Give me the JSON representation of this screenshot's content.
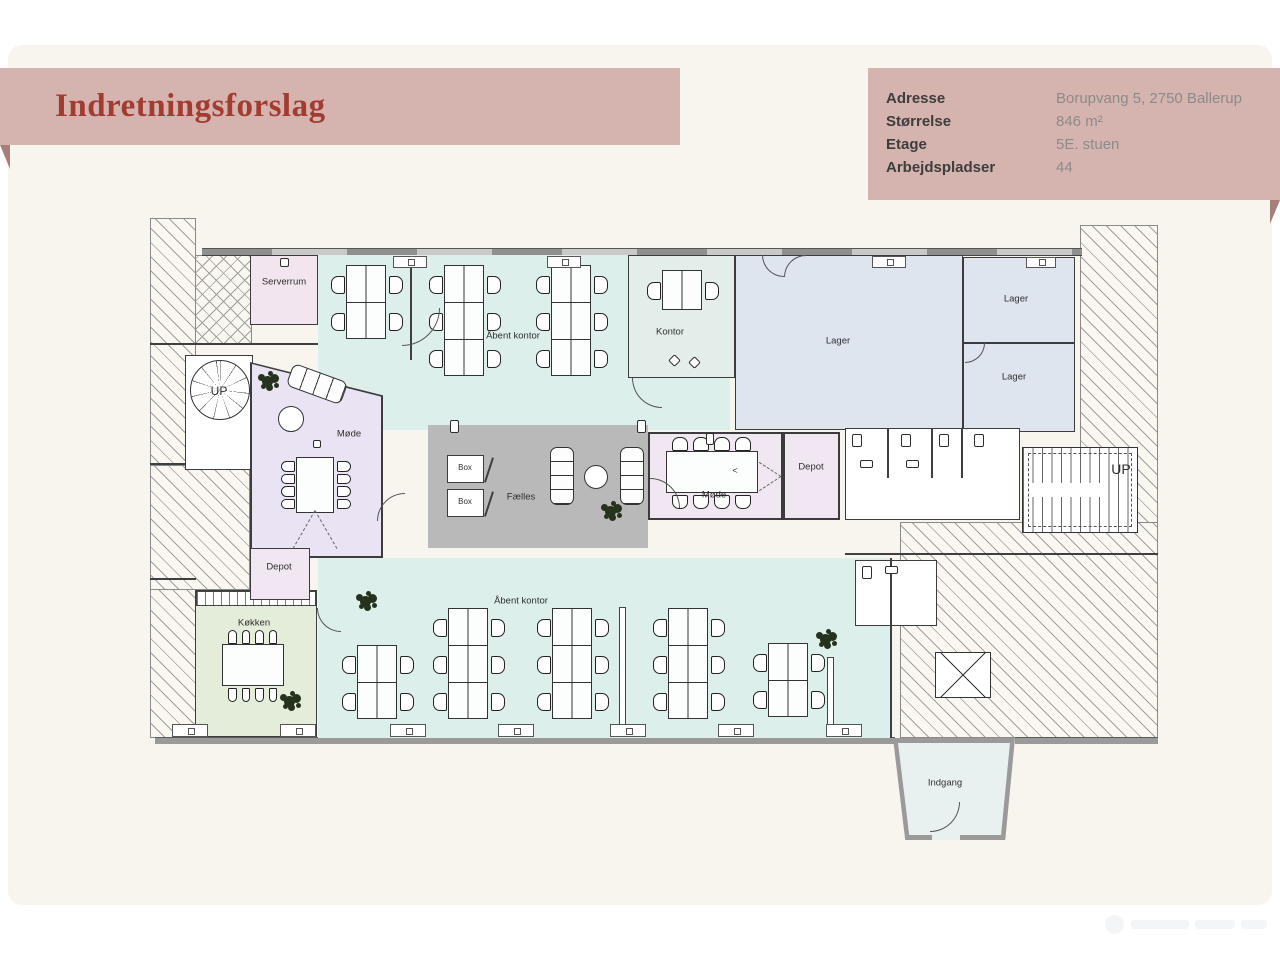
{
  "page": {
    "title": "Indretningsforslag"
  },
  "info": {
    "rows": [
      {
        "label": "Adresse",
        "value": "Borupvang 5, 2750 Ballerup"
      },
      {
        "label": "Størrelse",
        "value": "846 m²"
      },
      {
        "label": "Etage",
        "value": "5E. stuen"
      },
      {
        "label": "Arbejdspladser",
        "value": "44"
      }
    ]
  },
  "colors": {
    "teal": "#ddefeb",
    "blue": "#dfe5ee",
    "pink": "#f2e5ef",
    "lavender": "#eae3f3",
    "pinklight": "#f1e7f2",
    "gray": "#b9b9ba",
    "green": "#e4ecda",
    "kontorfill": "#e3edea",
    "white": "#ffffff",
    "entr": "#e8f1ef",
    "banner": "#d5b4b0",
    "fold": "#a87e7b",
    "title_red": "#a23b30",
    "card": "#f8f4ee",
    "wallgray": "#9a9a9a"
  },
  "plan": {
    "items": [
      {
        "t": "hatch",
        "name": "exterior-left",
        "x": 0,
        "y": 8,
        "w": 46,
        "h": 520
      },
      {
        "t": "hatch",
        "name": "exterior-left-mid",
        "x": 0,
        "y": 255,
        "w": 100,
        "h": 125
      },
      {
        "t": "cross",
        "name": "exterior-topleft",
        "x": 45,
        "y": 45,
        "w": 57,
        "h": 90
      },
      {
        "t": "hatch",
        "name": "exterior-right",
        "x": 930,
        "y": 15,
        "w": 78,
        "h": 513
      },
      {
        "t": "hatch",
        "name": "exterior-bottomright",
        "x": 750,
        "y": 312,
        "w": 258,
        "h": 216
      },
      {
        "t": "wallwin",
        "name": "facade-top",
        "x": 52,
        "y": 38,
        "w": 880,
        "h": 8
      },
      {
        "t": "gwall",
        "name": "facade-bottom-left",
        "x": 5,
        "y": 527,
        "w": 740,
        "h": 7
      },
      {
        "t": "gwall",
        "name": "facade-bottom-right",
        "x": 865,
        "y": 527,
        "w": 143,
        "h": 7
      },
      {
        "t": "wall",
        "name": "wall-topleft-divider",
        "x": 0,
        "y": 133,
        "w": 168,
        "h": 2
      },
      {
        "t": "wall",
        "name": "wall-leftband-cut1",
        "x": 0,
        "y": 253,
        "w": 46,
        "h": 2
      },
      {
        "t": "wall",
        "name": "wall-leftband-cut2",
        "x": 0,
        "y": 368,
        "w": 46,
        "h": 2
      },
      {
        "t": "room",
        "name": "room-open-office-top",
        "x": 168,
        "y": 45,
        "w": 412,
        "h": 175,
        "fill": "teal",
        "b": 0
      },
      {
        "t": "room",
        "name": "room-open-office-bottom",
        "x": 168,
        "y": 348,
        "w": 572,
        "h": 180,
        "fill": "teal",
        "b": 0
      },
      {
        "t": "room",
        "name": "room-serverrum",
        "x": 100,
        "y": 45,
        "w": 68,
        "h": 70,
        "fill": "pink"
      },
      {
        "t": "room",
        "name": "room-kontor",
        "x": 478,
        "y": 45,
        "w": 107,
        "h": 123,
        "fill": "kontorfill"
      },
      {
        "t": "room",
        "name": "room-lager-big",
        "x": 585,
        "y": 45,
        "w": 228,
        "h": 175,
        "fill": "blue"
      },
      {
        "t": "room",
        "name": "room-lager-top",
        "x": 813,
        "y": 47,
        "w": 112,
        "h": 86,
        "fill": "blue"
      },
      {
        "t": "room",
        "name": "room-lager-bottom",
        "x": 813,
        "y": 133,
        "w": 112,
        "h": 89,
        "fill": "blue"
      },
      {
        "t": "room",
        "name": "room-stair-left",
        "x": 35,
        "y": 145,
        "w": 68,
        "h": 115,
        "fill": "white"
      },
      {
        "t": "poly",
        "name": "room-moede-left",
        "x": 100,
        "y": 152,
        "w": 133,
        "h": 196,
        "fill": "lavender",
        "clip": "polygon(0 0,100% 17%,100% 100%,0 100%)",
        "inset": 2
      },
      {
        "t": "room",
        "name": "room-koekken",
        "x": 45,
        "y": 380,
        "w": 122,
        "h": 147,
        "fill": "green"
      },
      {
        "t": "counter",
        "name": "kitchen-counter",
        "x": 46,
        "y": 381,
        "w": 120,
        "h": 15
      },
      {
        "t": "room",
        "name": "room-depot-left",
        "x": 100,
        "y": 338,
        "w": 60,
        "h": 52,
        "fill": "pinklight"
      },
      {
        "t": "room",
        "name": "room-faelles",
        "x": 278,
        "y": 215,
        "w": 220,
        "h": 123,
        "fill": "gray",
        "b": 0
      },
      {
        "t": "room",
        "name": "room-moede-center",
        "x": 498,
        "y": 222,
        "w": 135,
        "h": 88,
        "fill": "pinklight",
        "bw": 2
      },
      {
        "t": "room",
        "name": "room-depot-center",
        "x": 633,
        "y": 222,
        "w": 57,
        "h": 88,
        "fill": "pinklight",
        "bw": 2
      },
      {
        "t": "room",
        "name": "room-toilets",
        "x": 695,
        "y": 218,
        "w": 175,
        "h": 92,
        "fill": "white"
      },
      {
        "t": "room",
        "name": "room-toilet-br",
        "x": 705,
        "y": 350,
        "w": 82,
        "h": 66,
        "fill": "white"
      },
      {
        "t": "stair",
        "name": "stair-right",
        "x": 872,
        "y": 237,
        "w": 116,
        "h": 86
      },
      {
        "t": "poly",
        "name": "entrance-vestibule",
        "x": 743,
        "y": 528,
        "w": 122,
        "h": 102,
        "fill": "entr",
        "clip": "polygon(0 0,100% 0,92% 100%,10% 100%)",
        "inset": 5,
        "wallFill": "wallgray"
      },
      {
        "t": "gap",
        "name": "entrance-door-gap",
        "x": 782,
        "y": 621,
        "w": 28,
        "h": 9,
        "fill": "entr"
      },
      {
        "t": "wall",
        "name": "wall-office-east",
        "x": 740,
        "y": 348,
        "w": 2,
        "h": 180
      },
      {
        "t": "wall",
        "name": "wall-hatch-top",
        "x": 695,
        "y": 343,
        "w": 313,
        "h": 2
      },
      {
        "t": "wall",
        "name": "toilet-divider-1",
        "x": 737,
        "y": 218,
        "w": 2,
        "h": 50
      },
      {
        "t": "wall",
        "name": "toilet-divider-2",
        "x": 781,
        "y": 218,
        "w": 2,
        "h": 50
      },
      {
        "t": "wall",
        "name": "toilet-divider-3",
        "x": 811,
        "y": 218,
        "w": 2,
        "h": 50
      },
      {
        "t": "wall",
        "name": "partition-top-office",
        "x": 260,
        "y": 55,
        "w": 2,
        "h": 95
      },
      {
        "t": "post",
        "name": "partition-bottom-office-1",
        "x": 469,
        "y": 397,
        "w": 7,
        "h": 126
      },
      {
        "t": "post",
        "name": "partition-bottom-office-2",
        "x": 677,
        "y": 447,
        "w": 7,
        "h": 80
      },
      {
        "t": "room",
        "name": "phone-box-1",
        "x": 297,
        "y": 245,
        "w": 37,
        "h": 28,
        "fill": "white",
        "bw": 1.2
      },
      {
        "t": "room",
        "name": "phone-box-2",
        "x": 297,
        "y": 279,
        "w": 37,
        "h": 28,
        "fill": "white",
        "bw": 1.2
      },
      {
        "t": "wall",
        "name": "box-1-slash",
        "x": 338,
        "y": 247,
        "w": 2,
        "h": 26,
        "rot": 18
      },
      {
        "t": "wall",
        "name": "box-2-slash",
        "x": 338,
        "y": 281,
        "w": 2,
        "h": 26,
        "rot": 18
      },
      {
        "t": "vdesk",
        "name": "desk-cluster-4p-a",
        "x": 196,
        "y": 55,
        "rows": 2,
        "seats": 4
      },
      {
        "t": "vdesk",
        "name": "desk-cluster-6p-b",
        "x": 294,
        "y": 55,
        "rows": 3,
        "seats": 6
      },
      {
        "t": "vdesk",
        "name": "desk-cluster-6p-c",
        "x": 401,
        "y": 55,
        "rows": 3,
        "seats": 6
      },
      {
        "t": "vdesk",
        "name": "desk-kontor-2p",
        "x": 512,
        "y": 60,
        "rows": 1,
        "seats": 2
      },
      {
        "t": "vdesk",
        "name": "desk-cluster-4p-d",
        "x": 207,
        "y": 435,
        "rows": 2,
        "seats": 4
      },
      {
        "t": "vdesk",
        "name": "desk-cluster-6p-e",
        "x": 298,
        "y": 398,
        "rows": 3,
        "seats": 6
      },
      {
        "t": "vdesk",
        "name": "desk-cluster-6p-f",
        "x": 402,
        "y": 398,
        "rows": 3,
        "seats": 6
      },
      {
        "t": "vdesk",
        "name": "desk-cluster-6p-g",
        "x": 518,
        "y": 398,
        "rows": 3,
        "seats": 6
      },
      {
        "t": "vdesk",
        "name": "desk-cluster-4p-h",
        "x": 618,
        "y": 433,
        "rows": 2,
        "seats": 4
      },
      {
        "t": "vtable",
        "name": "conference-table-moede-left",
        "x": 146,
        "y": 247,
        "w": 38,
        "h": 56
      },
      {
        "t": "htable",
        "name": "conference-table-moede-center",
        "x": 516,
        "y": 241,
        "w": 92,
        "h": 42
      },
      {
        "t": "htable",
        "name": "dining-table-koekken",
        "x": 72,
        "y": 434,
        "w": 62,
        "h": 42
      },
      {
        "t": "sofa",
        "name": "sofa-moede-left",
        "x": 138,
        "y": 162,
        "w": 58,
        "h": 24,
        "rot": 20,
        "dir": "h"
      },
      {
        "t": "sofa",
        "name": "sofa-faelles-1",
        "x": 400,
        "y": 237,
        "w": 24,
        "h": 58,
        "dir": "v"
      },
      {
        "t": "sofa",
        "name": "sofa-faelles-2",
        "x": 470,
        "y": 237,
        "w": 24,
        "h": 58,
        "dir": "v"
      },
      {
        "t": "round",
        "name": "round-table-moede-left",
        "x": 128,
        "y": 196,
        "w": 26,
        "h": 26
      },
      {
        "t": "round",
        "name": "round-table-faelles",
        "x": 434,
        "y": 255,
        "w": 24,
        "h": 24
      },
      {
        "t": "spiral",
        "name": "spiral-stair-left",
        "x": 40,
        "y": 150,
        "w": 60,
        "h": 60
      },
      {
        "t": "plant",
        "name": "plant-moede-left",
        "x": 112,
        "y": 166
      },
      {
        "t": "plant",
        "name": "plant-faelles",
        "x": 455,
        "y": 296
      },
      {
        "t": "plant",
        "name": "plant-office-bottom-left",
        "x": 210,
        "y": 386
      },
      {
        "t": "plant",
        "name": "plant-office-bottom-right",
        "x": 670,
        "y": 424
      },
      {
        "t": "plant",
        "name": "plant-koekken",
        "x": 134,
        "y": 486
      },
      {
        "t": "sill",
        "name": "window-sill-top-1",
        "x": 243,
        "y": 46,
        "w": 34,
        "h": 12
      },
      {
        "t": "sill",
        "name": "window-sill-top-2",
        "x": 397,
        "y": 46,
        "w": 34,
        "h": 12
      },
      {
        "t": "sill",
        "name": "window-sill-top-3",
        "x": 722,
        "y": 46,
        "w": 34,
        "h": 12
      },
      {
        "t": "sill",
        "name": "window-sill-top-4",
        "x": 876,
        "y": 47,
        "w": 30,
        "h": 11
      },
      {
        "t": "sill",
        "name": "window-sill-bottom-1",
        "x": 22,
        "y": 514,
        "w": 36,
        "h": 13
      },
      {
        "t": "sill",
        "name": "window-sill-bottom-2",
        "x": 130,
        "y": 514,
        "w": 36,
        "h": 13
      },
      {
        "t": "sill",
        "name": "window-sill-bottom-3",
        "x": 240,
        "y": 514,
        "w": 36,
        "h": 13
      },
      {
        "t": "sill",
        "name": "window-sill-bottom-4",
        "x": 348,
        "y": 514,
        "w": 36,
        "h": 13
      },
      {
        "t": "sill",
        "name": "window-sill-bottom-5",
        "x": 460,
        "y": 514,
        "w": 36,
        "h": 13
      },
      {
        "t": "sill",
        "name": "window-sill-bottom-6",
        "x": 568,
        "y": 514,
        "w": 36,
        "h": 13
      },
      {
        "t": "sill",
        "name": "window-sill-bottom-7",
        "x": 676,
        "y": 514,
        "w": 36,
        "h": 13
      },
      {
        "t": "wc",
        "name": "wc-1",
        "x": 702,
        "y": 224,
        "w": 10,
        "h": 13
      },
      {
        "t": "wc",
        "name": "wc-2",
        "x": 751,
        "y": 224,
        "w": 10,
        "h": 13
      },
      {
        "t": "wc",
        "name": "wc-3",
        "x": 789,
        "y": 224,
        "w": 10,
        "h": 13
      },
      {
        "t": "wc",
        "name": "wc-4",
        "x": 824,
        "y": 224,
        "w": 10,
        "h": 13
      },
      {
        "t": "wc",
        "name": "sink-1",
        "x": 710,
        "y": 250,
        "w": 13,
        "h": 8
      },
      {
        "t": "wc",
        "name": "sink-2",
        "x": 756,
        "y": 250,
        "w": 13,
        "h": 8
      },
      {
        "t": "wc",
        "name": "wc-br",
        "x": 712,
        "y": 356,
        "w": 10,
        "h": 13
      },
      {
        "t": "wc",
        "name": "sink-br",
        "x": 735,
        "y": 356,
        "w": 13,
        "h": 8
      },
      {
        "t": "xbox",
        "name": "shaft-box",
        "x": 785,
        "y": 442,
        "w": 56,
        "h": 46
      },
      {
        "t": "wc",
        "name": "faelles-door-post-1",
        "x": 300,
        "y": 210,
        "w": 9,
        "h": 13
      },
      {
        "t": "wc",
        "name": "faelles-door-post-2",
        "x": 487,
        "y": 210,
        "w": 9,
        "h": 13
      },
      {
        "t": "wc",
        "name": "serverrum-fixture",
        "x": 130,
        "y": 48,
        "w": 9,
        "h": 9
      },
      {
        "t": "wc",
        "name": "moede-center-fixture",
        "x": 556,
        "y": 223,
        "w": 8,
        "h": 12
      },
      {
        "t": "wc",
        "name": "moede-left-fixture",
        "x": 163,
        "y": 230,
        "w": 8,
        "h": 8
      },
      {
        "t": "wc",
        "name": "kontor-side-chair-1",
        "x": 520,
        "y": 146,
        "w": 9,
        "h": 9,
        "rot": 45
      },
      {
        "t": "wc",
        "name": "kontor-side-chair-2",
        "x": 540,
        "y": 148,
        "w": 9,
        "h": 9,
        "rot": 45
      },
      {
        "t": "arc",
        "name": "door-serverrum",
        "x": 252,
        "y": 98,
        "w": 38,
        "h": 38,
        "rot": 0
      },
      {
        "t": "arc",
        "name": "door-kontor",
        "x": 482,
        "y": 168,
        "w": 30,
        "h": 30,
        "rot": 90
      },
      {
        "t": "arc",
        "name": "door-moede-center",
        "x": 500,
        "y": 268,
        "w": 30,
        "h": 30,
        "rot": 270
      },
      {
        "t": "arc",
        "name": "door-moede-left",
        "x": 227,
        "y": 283,
        "w": 28,
        "h": 28,
        "rot": 180
      },
      {
        "t": "arc",
        "name": "door-entrance",
        "x": 780,
        "y": 592,
        "w": 30,
        "h": 30,
        "rot": 0
      },
      {
        "t": "arc",
        "name": "door-lager-double-1",
        "x": 612,
        "y": 45,
        "w": 22,
        "h": 22,
        "rot": 90
      },
      {
        "t": "arc",
        "name": "door-lager-double-2",
        "x": 634,
        "y": 45,
        "w": 22,
        "h": 22,
        "rot": 180
      },
      {
        "t": "arc",
        "name": "door-lager-mid",
        "x": 815,
        "y": 133,
        "w": 20,
        "h": 20,
        "rot": 0
      },
      {
        "t": "arc",
        "name": "door-koekken",
        "x": 167,
        "y": 398,
        "w": 24,
        "h": 24,
        "rot": 90
      },
      {
        "t": "dash",
        "name": "projection-line-left-1",
        "x": 165,
        "y": 300,
        "w": 44,
        "rot": 60
      },
      {
        "t": "dash",
        "name": "projection-line-left-2",
        "x": 165,
        "y": 300,
        "w": 44,
        "rot": 120
      },
      {
        "t": "dash",
        "name": "projection-line-center-1",
        "x": 631,
        "y": 266,
        "w": 26,
        "rot": 147
      },
      {
        "t": "dash",
        "name": "projection-line-center-2",
        "x": 631,
        "y": 266,
        "w": 26,
        "rot": 213
      },
      {
        "t": "label",
        "name": "label-serverrum",
        "x": 134,
        "y": 72,
        "label": "Serverrum"
      },
      {
        "t": "label",
        "name": "label-open-office-top",
        "x": 363,
        "y": 126,
        "label": "Åbent kontor"
      },
      {
        "t": "label",
        "name": "label-kontor",
        "x": 520,
        "y": 122,
        "label": "Kontor"
      },
      {
        "t": "label",
        "name": "label-lager-big",
        "x": 688,
        "y": 131,
        "label": "Lager"
      },
      {
        "t": "label",
        "name": "label-lager-top",
        "x": 866,
        "y": 89,
        "label": "Lager"
      },
      {
        "t": "label",
        "name": "label-lager-bottom",
        "x": 864,
        "y": 167,
        "label": "Lager"
      },
      {
        "t": "label",
        "name": "label-moede-left",
        "x": 199,
        "y": 224,
        "label": "Møde"
      },
      {
        "t": "label",
        "name": "label-depot-left",
        "x": 129,
        "y": 357,
        "label": "Depot"
      },
      {
        "t": "label",
        "name": "label-koekken",
        "x": 104,
        "y": 413,
        "label": "Køkken"
      },
      {
        "t": "label",
        "name": "label-faelles",
        "x": 371,
        "y": 287,
        "label": "Fælles"
      },
      {
        "t": "label",
        "name": "label-box-1",
        "x": 315,
        "y": 258,
        "label": "Box",
        "fs": 8
      },
      {
        "t": "label",
        "name": "label-box-2",
        "x": 315,
        "y": 292,
        "label": "Box",
        "fs": 8
      },
      {
        "t": "label",
        "name": "label-moede-center",
        "x": 564,
        "y": 285,
        "label": "Møde"
      },
      {
        "t": "label",
        "name": "label-depot-center",
        "x": 661,
        "y": 257,
        "label": "Depot"
      },
      {
        "t": "label",
        "name": "label-open-office-bottom",
        "x": 371,
        "y": 391,
        "label": "Åbent kontor"
      },
      {
        "t": "label",
        "name": "label-indgang",
        "x": 795,
        "y": 573,
        "label": "Indgang"
      },
      {
        "t": "label",
        "name": "label-up-left",
        "x": 69,
        "y": 181,
        "label": "UP",
        "fs": 12
      },
      {
        "t": "label",
        "name": "label-up-right",
        "x": 971,
        "y": 259,
        "label": "UP",
        "fs": 14
      },
      {
        "t": "label",
        "name": "label-projector-arrow",
        "x": 585,
        "y": 261,
        "label": "<",
        "fs": 9
      }
    ]
  }
}
